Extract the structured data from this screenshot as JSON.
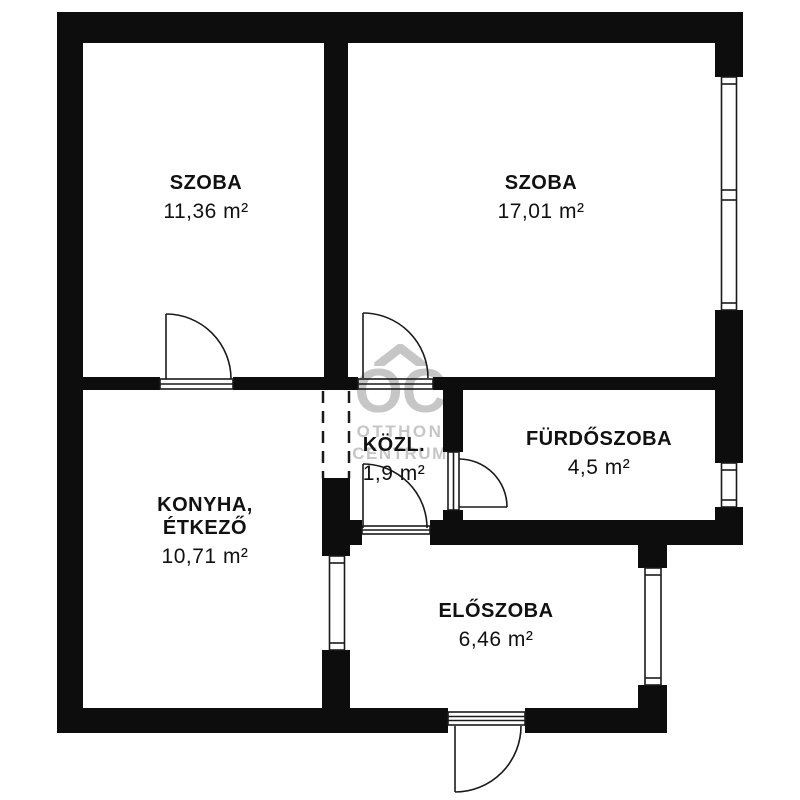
{
  "plan": {
    "watermark": {
      "logo_text": "OC",
      "brand_line1": "OTTHON",
      "brand_line2": "CENTRUM",
      "color": "#c6c6c6"
    },
    "rooms": [
      {
        "id": "szoba-1",
        "name": "SZOBA",
        "area": "11,36 m²"
      },
      {
        "id": "szoba-2",
        "name": "SZOBA",
        "area": "17,01 m²"
      },
      {
        "id": "furdoszoba",
        "name": "FÜRDŐSZOBA",
        "area": "4,5 m²"
      },
      {
        "id": "kozlekedo",
        "name": "KÖZL.",
        "area": "1,9 m²"
      },
      {
        "id": "konyha-etkezo",
        "name": "KONYHA,",
        "name_line2": "ÉTKEZŐ",
        "area": "10,71 m²"
      },
      {
        "id": "eloszoba",
        "name": "ELŐSZOBA",
        "area": "6,46 m²"
      }
    ],
    "colors": {
      "wall": "#0d0d0d",
      "line": "#1a1a1a",
      "background": "#ffffff",
      "watermark": "#c6c6c6"
    }
  }
}
